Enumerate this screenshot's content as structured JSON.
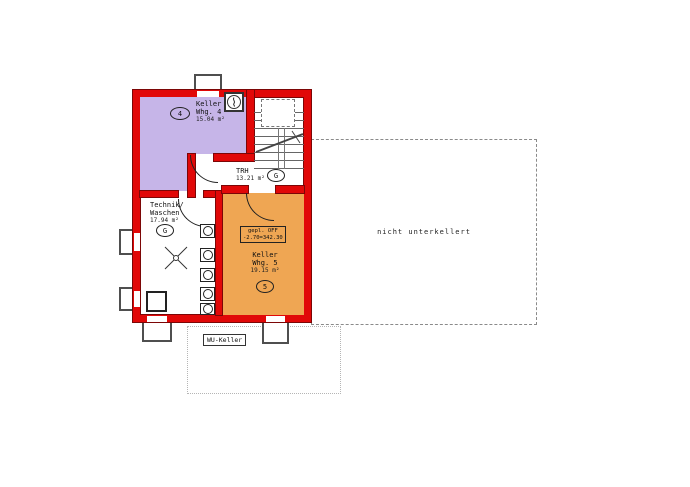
{
  "rooms": {
    "whg4": {
      "badge": "4",
      "line1": "Keller",
      "line2": "Whg. 4",
      "area": "15.04 m²"
    },
    "trh": {
      "name": "TRH",
      "area": "13.21 m²",
      "badge": "G"
    },
    "technik": {
      "line1": "Technik/",
      "line2": "Waschen",
      "area": "17.94 m²",
      "badge": "G"
    },
    "whg5": {
      "badge": "5",
      "line1": "Keller",
      "line2": "Whg. 5",
      "area": "19.15 m²",
      "level1": "gepl. OFF",
      "level2": "-2.70=342.30"
    }
  },
  "annotations": {
    "nicht_unterkellert": "nicht unterkellert",
    "wu_keller": "WU-Keller"
  },
  "colors": {
    "wall_red": "#e10808",
    "wall_edge": "#7c0606",
    "room_whg4": "#c6b5e8",
    "room_whg5": "#efa653"
  }
}
